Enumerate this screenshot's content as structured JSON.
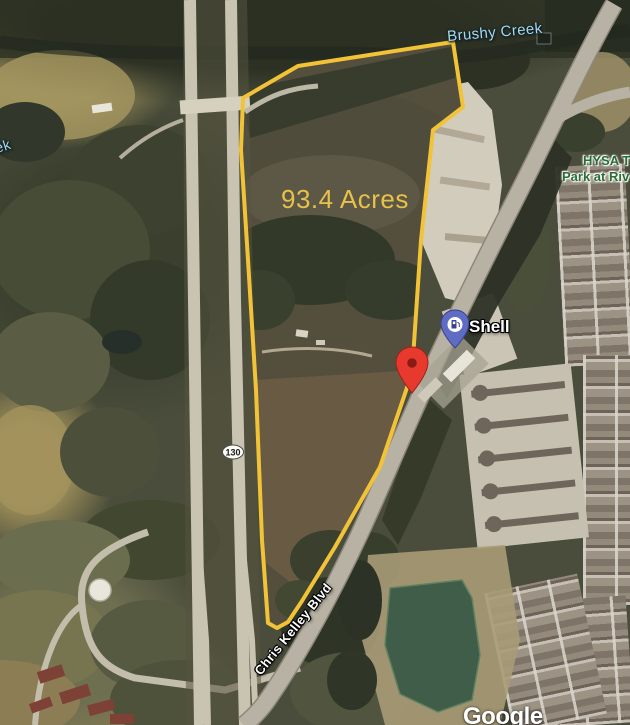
{
  "map": {
    "parcel": {
      "acreage_label": "93.4 Acres"
    },
    "labels": {
      "creek": "Brushy Creek",
      "creek_fragment": "ek",
      "park_line1": "HYSA T",
      "park_line2": "Park at Riv",
      "road": "Chris Kelley Blvd",
      "highway_shield": "130",
      "gas_station": "Shell"
    },
    "attribution": "Google",
    "icons": {
      "gas_station_pin": "gas-pump-pin-icon",
      "selected_location_pin": "red-map-pin-icon",
      "highway_shield": "oval-route-shield-icon"
    },
    "colors": {
      "parcel_outline": "#F2C337",
      "acreage_text": "#E7C24A",
      "creek_text": "#A7D9EE",
      "park_text": "#2A6D33",
      "gas_pin": "#5F6CC4",
      "location_pin": "#E8392E",
      "pond": "#3F5D49"
    }
  }
}
